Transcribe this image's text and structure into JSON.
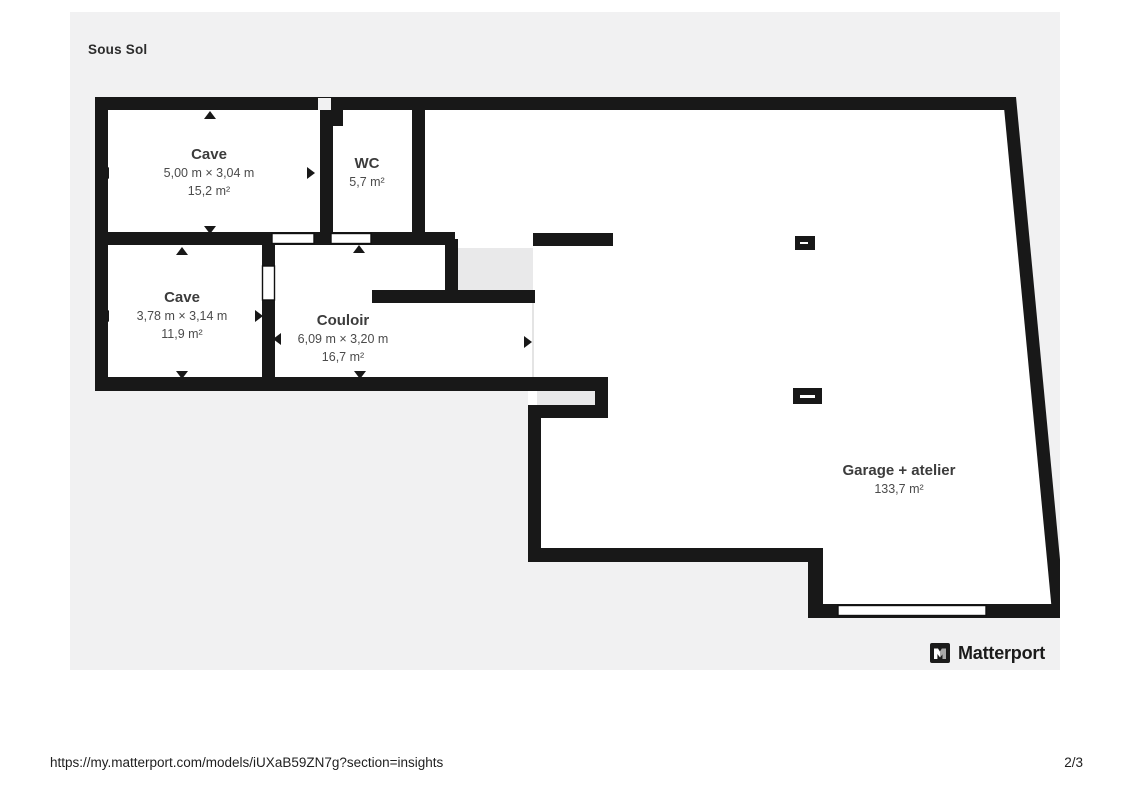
{
  "page": {
    "title": "Sous Sol",
    "footer_url": "https://my.matterport.com/models/iUXaB59ZN7g?section=insights",
    "page_indicator": "2/3"
  },
  "branding": {
    "logo_text": "Matterport",
    "logo_icon": "matterport-logo-icon"
  },
  "floorplan": {
    "colors": {
      "wall": "#181818",
      "canvas_background": "#f1f1f2",
      "room_fill": "#ffffff",
      "stair_fill": "#e9e9ea"
    },
    "rooms": [
      {
        "id": "cave-1",
        "name": "Cave",
        "dimensions": "5,00 m × 3,04 m",
        "area": "15,2 m²"
      },
      {
        "id": "wc",
        "name": "WC",
        "dimensions": "",
        "area": "5,7 m²"
      },
      {
        "id": "cave-2",
        "name": "Cave",
        "dimensions": "3,78 m × 3,14 m",
        "area": "11,9 m²"
      },
      {
        "id": "couloir",
        "name": "Couloir",
        "dimensions": "6,09 m × 3,20 m",
        "area": "16,7 m²"
      },
      {
        "id": "garage",
        "name": "Garage + atelier",
        "dimensions": "",
        "area": "133,7 m²"
      }
    ]
  }
}
